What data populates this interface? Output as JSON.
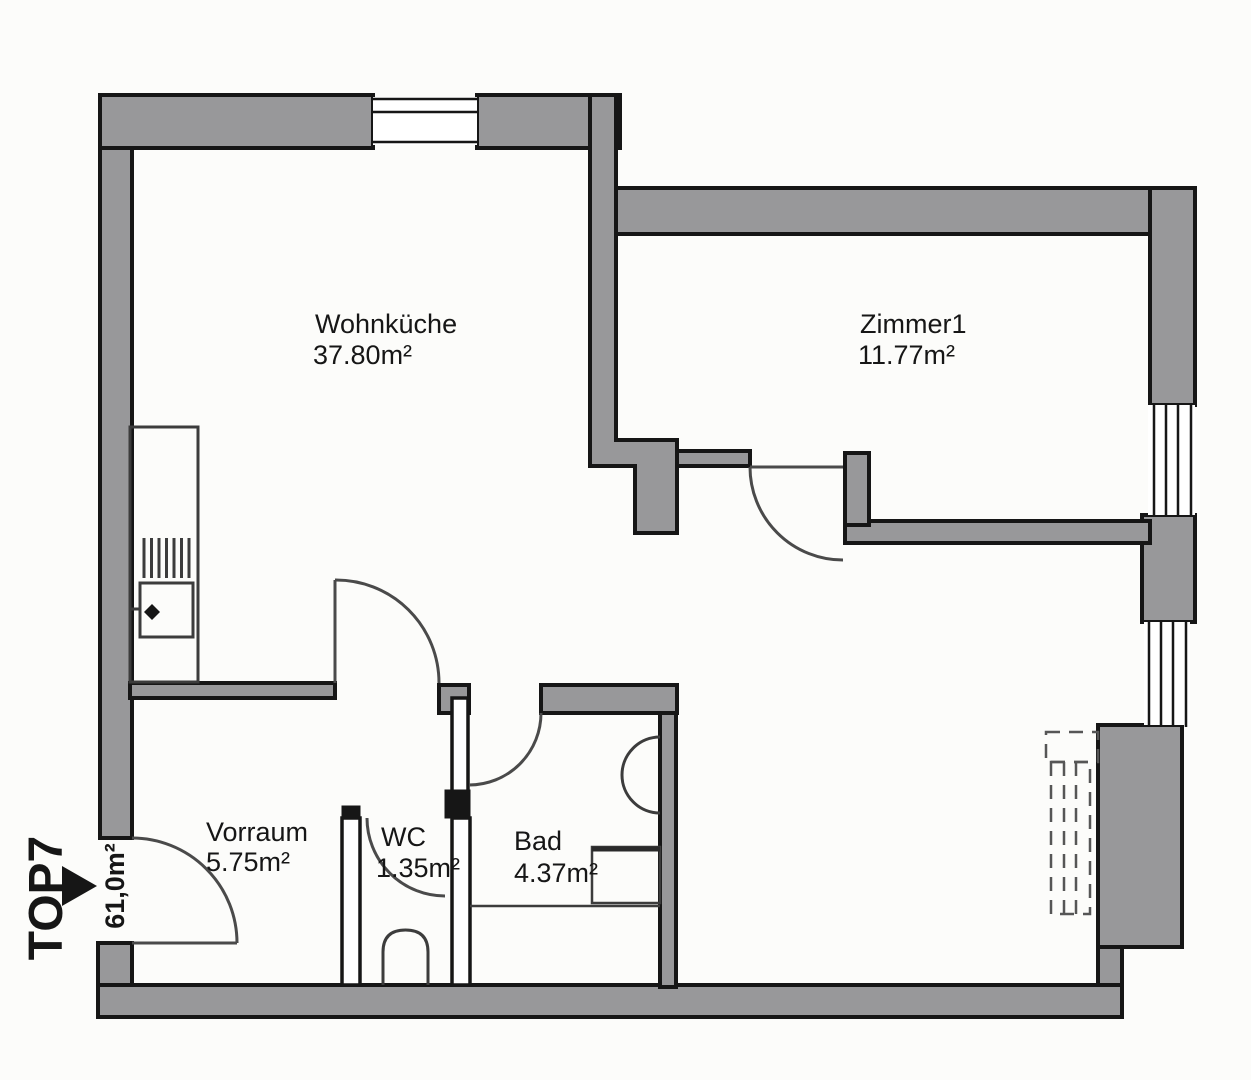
{
  "unit": {
    "label": "TOP7",
    "total_area": "61,0m²"
  },
  "rooms": [
    {
      "id": "wohnkueche",
      "name": "Wohnküche",
      "area": "37.80m²"
    },
    {
      "id": "zimmer1",
      "name": "Zimmer1",
      "area": "11.77m²"
    },
    {
      "id": "vorraum",
      "name": "Vorraum",
      "area": "5.75m²"
    },
    {
      "id": "wc",
      "name": "WC",
      "area": "1.35m²"
    },
    {
      "id": "bad",
      "name": "Bad",
      "area": "4.37m²"
    }
  ],
  "icons": {
    "entrance_arrow": "right-pointing-triangle"
  },
  "colors": {
    "wall_fill": "#98989a",
    "wall_outline": "#161616",
    "door_stroke": "#4a4a4a",
    "fixture_stroke": "#3c3c3c",
    "text_color": "#161616",
    "bg": "#fcfcfa"
  }
}
